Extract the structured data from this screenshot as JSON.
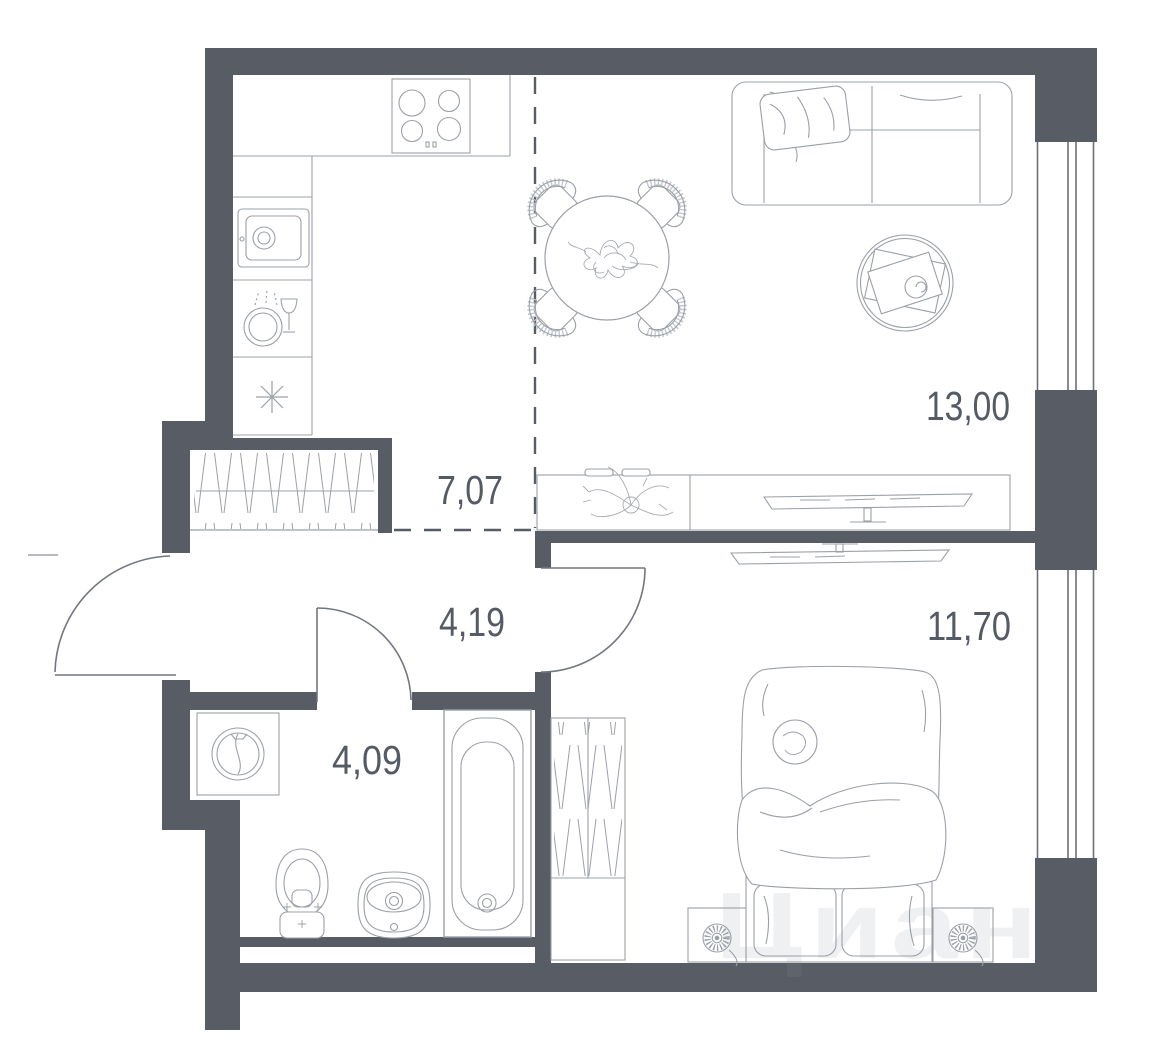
{
  "plan": {
    "type": "apartment-floor-plan",
    "colors": {
      "wall": "#575c65",
      "furniture_line": "#9ba0a8",
      "door_line": "#71767f",
      "label": "#555a64",
      "background": "#ffffff"
    },
    "rooms": [
      {
        "name": "kitchen",
        "area": "7,07"
      },
      {
        "name": "living-room",
        "area": "13,00"
      },
      {
        "name": "hallway",
        "area": "4,19"
      },
      {
        "name": "bathroom",
        "area": "4,09"
      },
      {
        "name": "bedroom",
        "area": "11,70"
      }
    ],
    "watermark": {
      "text": "Циан"
    },
    "icons": [
      "stove-icon",
      "kitchen-sink-icon",
      "dishwasher-icon",
      "fridge-snowflake-icon",
      "dining-table-icon",
      "chair-icon",
      "sofa-icon",
      "coffee-table-icon",
      "plant-icon",
      "tv-icon",
      "wardrobe-icon",
      "washing-machine-icon",
      "toilet-icon",
      "washbasin-icon",
      "bathtub-icon",
      "bed-icon",
      "nightstand-fan-icon",
      "window-icon",
      "door-swing-icon"
    ]
  }
}
